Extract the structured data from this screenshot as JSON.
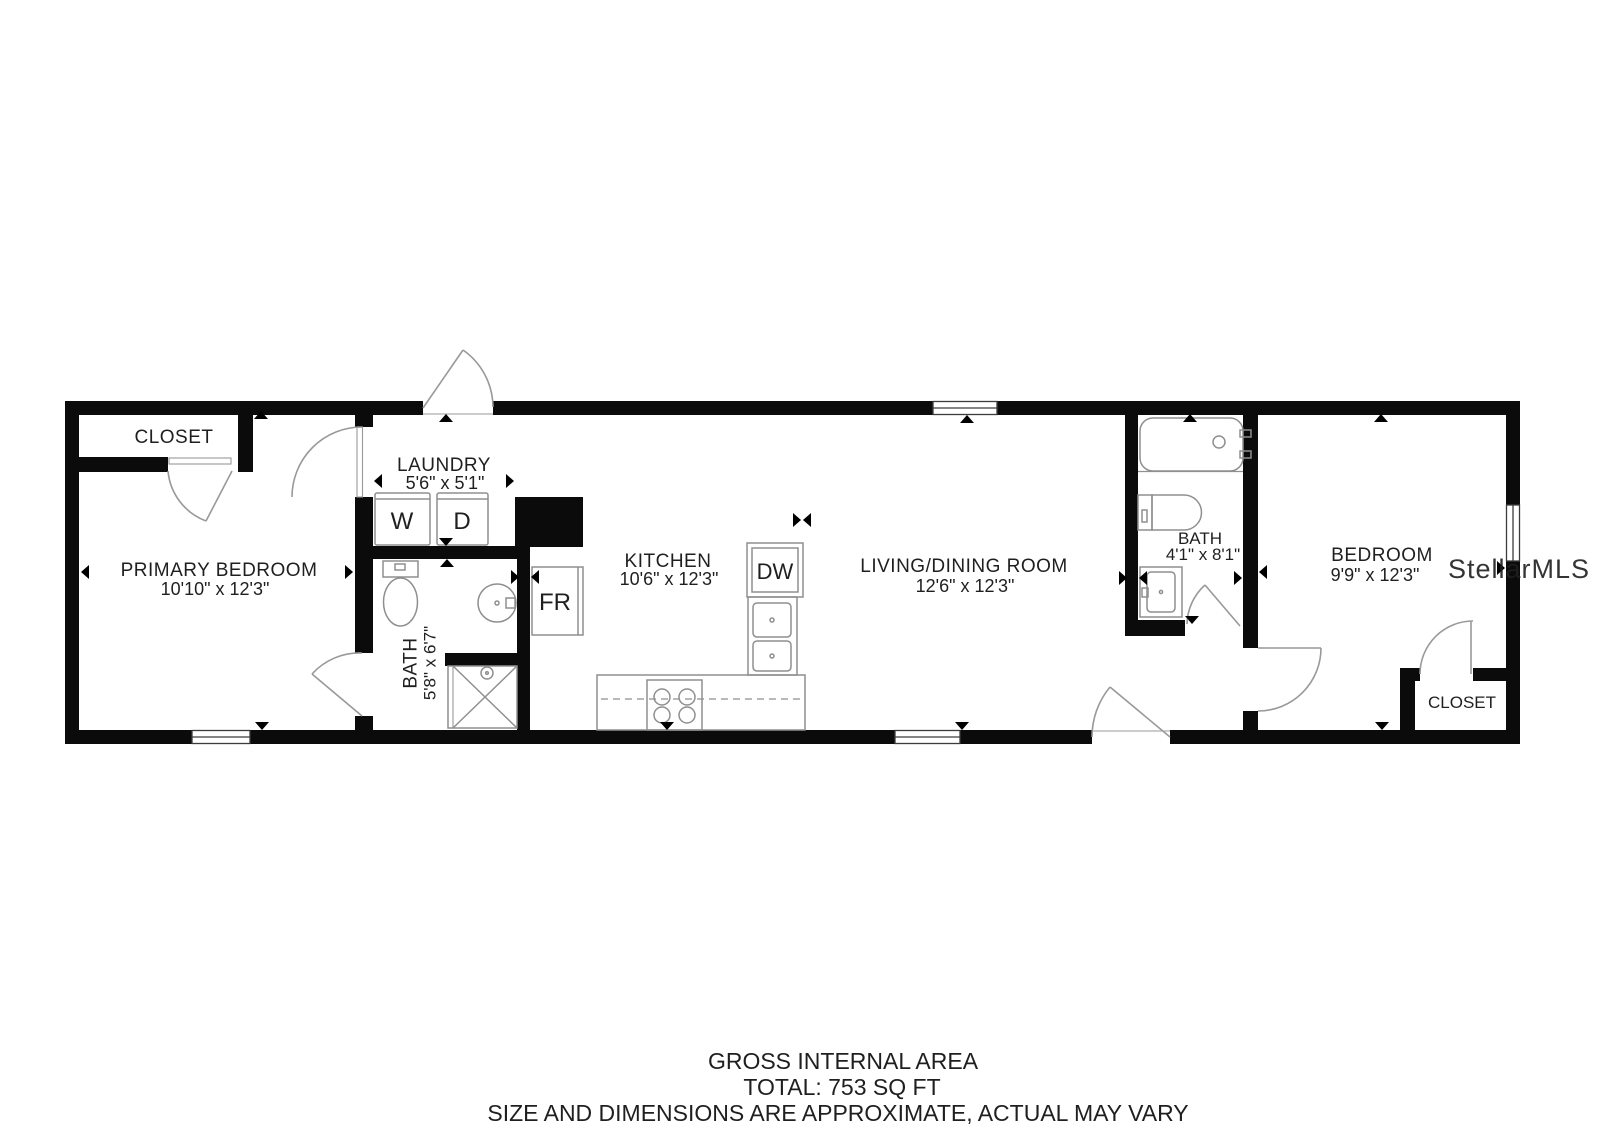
{
  "plan": {
    "type": "floorplan",
    "rooms": {
      "primary_closet": {
        "name": "CLOSET"
      },
      "primary_bedroom": {
        "name": "PRIMARY BEDROOM",
        "dims": "10'10\" x 12'3\""
      },
      "laundry": {
        "name": "LAUNDRY",
        "dims": "5'6\" x 5'1\""
      },
      "bath_left": {
        "name": "BATH",
        "dims": "5'8\" x 6'7\""
      },
      "kitchen": {
        "name": "KITCHEN",
        "dims": "10'6\" x 12'3\""
      },
      "living_dining": {
        "name": "LIVING/DINING ROOM",
        "dims": "12'6\" x 12'3\""
      },
      "bath_right": {
        "name": "BATH",
        "dims": "4'1\" x 8'1\""
      },
      "bedroom": {
        "name": "BEDROOM",
        "dims": "9'9\" x 12'3\""
      },
      "bedroom_closet": {
        "name": "CLOSET"
      }
    },
    "appliances": {
      "washer": "W",
      "dryer": "D",
      "fridge": "FR",
      "dishwasher": "DW"
    },
    "footer": {
      "line1": "GROSS INTERNAL AREA",
      "line2": "TOTAL: 753 SQ FT",
      "line3": "SIZE AND DIMENSIONS ARE APPROXIMATE, ACTUAL MAY VARY"
    },
    "watermark": "StellarMLS",
    "colors": {
      "wall": "#0b0b0b",
      "door_arc": "#999999",
      "fixture": "#8f8f8f",
      "window_frame": "#3c3c3c",
      "text": "#1f1f1f",
      "muted": "#8e8e8e",
      "watermark": "#d7d7d7",
      "marker": "#000000"
    }
  }
}
